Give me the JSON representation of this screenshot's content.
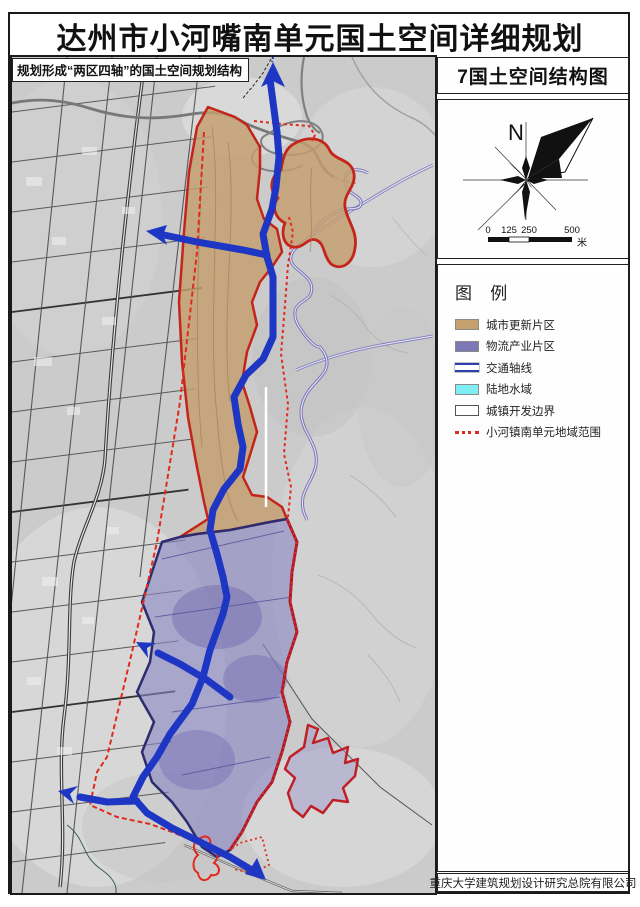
{
  "page": {
    "title": "达州市小河嘴南单元国土空间详细规划"
  },
  "map": {
    "overlay_label": "规划形成“两区四轴”的国土空间规划结构",
    "axis_color": "#1e36c4",
    "boundary_color": "#e02a1c"
  },
  "panel": {
    "drawing_title": "7国土空间结构图",
    "compass": {
      "north_label": "N"
    },
    "scale_bar": {
      "ticks": [
        "0",
        "125",
        "250",
        "500"
      ],
      "unit": "米"
    },
    "legend": {
      "title": "图 例",
      "items": [
        {
          "label": "城市更新片区",
          "swatch": "fill",
          "color": "#c4a06c"
        },
        {
          "label": "物流产业片区",
          "swatch": "fill",
          "color": "#7d79b6"
        },
        {
          "label": "交通轴线",
          "swatch": "double-line",
          "color": "#2b3fae"
        },
        {
          "label": "陆地水域",
          "swatch": "fill",
          "color": "#7feef2"
        },
        {
          "label": "城镇开发边界",
          "swatch": "outline",
          "color": "#ffffff"
        },
        {
          "label": "小河镇南单元地域范围",
          "swatch": "dotted-line",
          "color": "#e02a1c"
        }
      ]
    },
    "credit": "重庆大学建筑规划设计研究总院有限公司"
  }
}
